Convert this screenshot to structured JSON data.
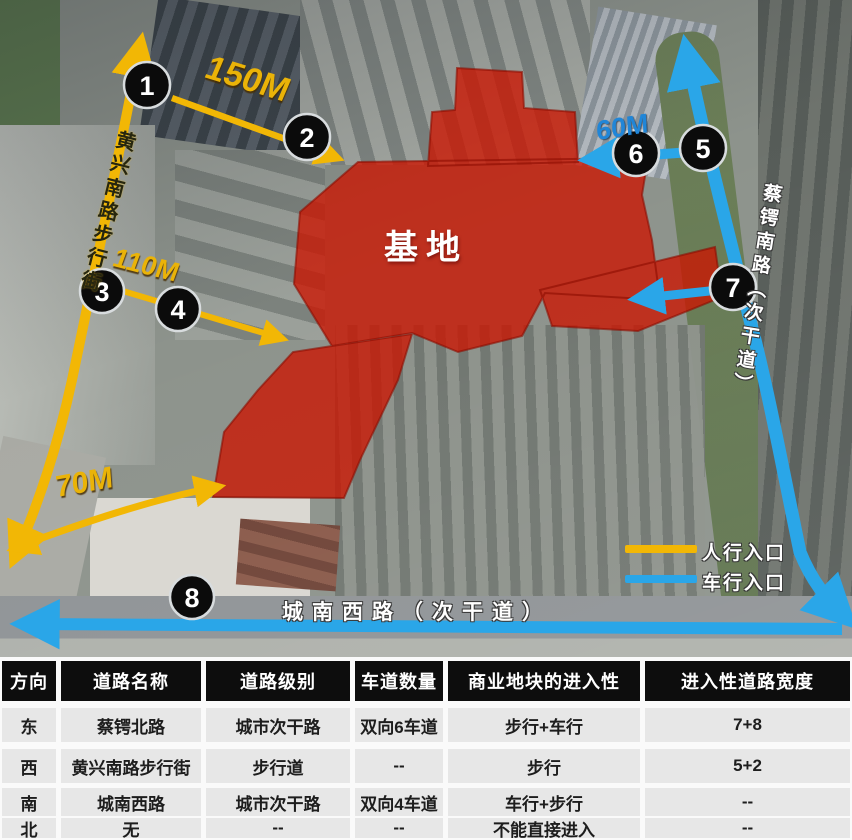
{
  "map": {
    "site_label": "基地",
    "distances": {
      "west_top": "150M",
      "west_mid": "110M",
      "south_west": "70M",
      "north_east": "60M"
    },
    "roads": {
      "west": "黄兴南路步行街",
      "east": "蔡锷南路（次干道）",
      "south": "城南西路（次干道）"
    },
    "markers": [
      "1",
      "2",
      "3",
      "4",
      "5",
      "6",
      "7",
      "8"
    ],
    "legend": {
      "pedestrian_label": "人行入口",
      "vehicle_label": "车行入口"
    },
    "colors": {
      "site_fill": "#cc1400",
      "pedestrian_route": "#f2b705",
      "vehicle_route": "#2aa6e8"
    }
  },
  "table": {
    "headers": [
      "方向",
      "道路名称",
      "道路级别",
      "车道数量",
      "商业地块的进入性",
      "进入性道路宽度"
    ],
    "rows": [
      [
        "东",
        "蔡锷北路",
        "城市次干路",
        "双向6车道",
        "步行+车行",
        "7+8"
      ],
      [
        "西",
        "黄兴南路步行街",
        "步行道",
        "--",
        "步行",
        "5+2"
      ],
      [
        "南",
        "城南西路",
        "城市次干路",
        "双向4车道",
        "车行+步行",
        "--"
      ],
      [
        "北",
        "无",
        "--",
        "--",
        "不能直接进入",
        "--"
      ]
    ]
  }
}
